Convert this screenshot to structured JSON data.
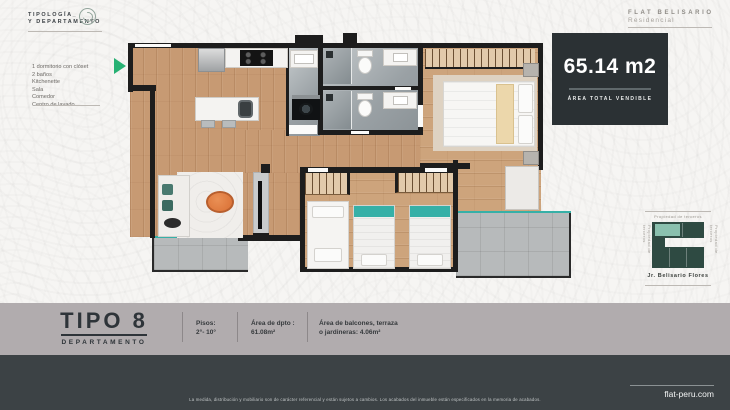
{
  "header": {
    "typology": {
      "line1": "TIPOLOGÍA_",
      "line2": "Y DEPARTAMENTO"
    },
    "brand": {
      "line1": "FLAT BELISARIO",
      "line2": "Residencial"
    }
  },
  "features": {
    "items": [
      "1 dormitorio con clóset",
      "2 baños",
      "Kitchenette",
      "Sala",
      "Comedor",
      "Centro de lavado"
    ]
  },
  "area_box": {
    "value": "65.14 m2",
    "caption": "ÁREA TOTAL VENDIBLE"
  },
  "key_map": {
    "top_label": "Propiedad de terceros",
    "left_label": "Propiedad de terceros",
    "right_label": "Propiedad de terceros",
    "street_label": "Jr. Belisario Flores"
  },
  "footer": {
    "type_title": "TIPO 8",
    "type_subtitle": "DEPARTAMENTO",
    "specs": [
      {
        "line1": "Pisos:",
        "line2": "2°- 10°"
      },
      {
        "line1": "Área de dpto :",
        "line2": "61.08m²"
      },
      {
        "line1": "Área de balcones, terraza",
        "line2": "o jardineras: 4.06m²"
      }
    ],
    "disclaimer": "La medida, distribución y mobiliario son de carácter referencial y están sujetos a cambios. Los acabados del inmueble están especificados en la memoria de acabados.",
    "website": "flat-peru.com"
  },
  "colors": {
    "accent_green": "#27b173",
    "teal": "#36b0a7",
    "wall": "#1d1d1d",
    "wood": "#c79a73",
    "dark_panel": "#2b3134",
    "footer_gray": "#b1acae",
    "footer_dark": "#3c4245",
    "map_building": "#2e4a42",
    "map_highlight": "#8ac0ae"
  }
}
